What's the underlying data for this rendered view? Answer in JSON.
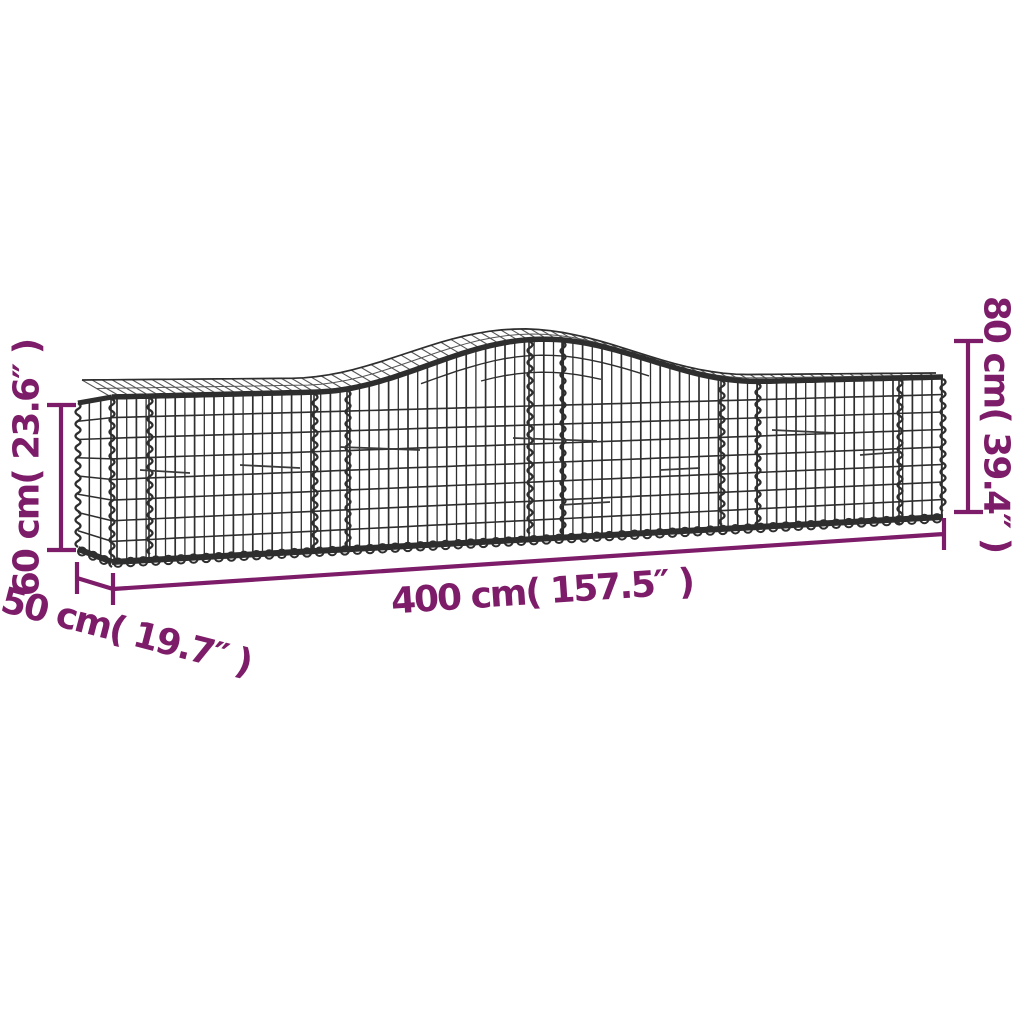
{
  "title": "Arched gabion basket dimension diagram",
  "colors": {
    "accent": "#7D1C68",
    "wire": "#2E2E2E",
    "wire_light": "#555555",
    "background": "#FFFFFF"
  },
  "labels": {
    "height_left": "60 cm( 23.6″ )",
    "height_right": "80 cm( 39.4″ )",
    "length": "400 cm( 157.5″ )",
    "depth": "50 cm( 19.7″ )"
  }
}
